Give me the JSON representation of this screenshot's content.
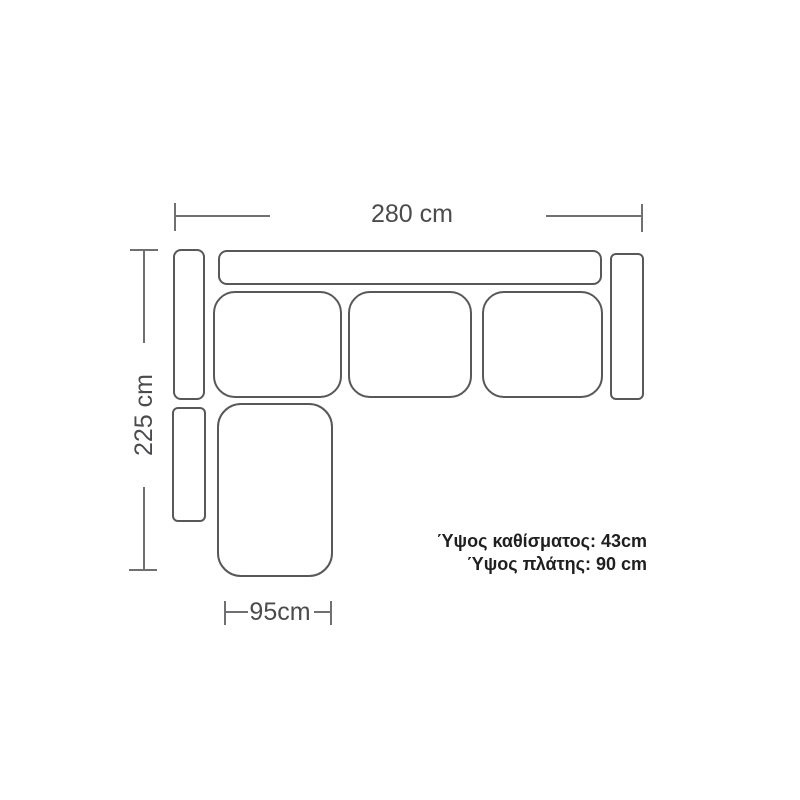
{
  "diagram": {
    "type": "sofa-top-view-dimension-diagram",
    "labels": {
      "width": "280 cm",
      "depth": "225 cm",
      "chaise_width": "95cm"
    },
    "notes": {
      "seat_height": "Ύψος καθίσματος: 43cm",
      "back_height": "Ύψος πλάτης: 90 cm"
    },
    "pieces": [
      "backrest",
      "left-armrest-upper",
      "left-armrest-lower",
      "right-armrest",
      "seat-cushion-1",
      "seat-cushion-2",
      "seat-cushion-3",
      "chaise-seat"
    ],
    "colors": {
      "background": "#ffffff",
      "outline": "#57585a",
      "dimension_line": "#707073",
      "dimension_text": "#4b4b4d",
      "note_text": "#1f1f1f"
    }
  }
}
